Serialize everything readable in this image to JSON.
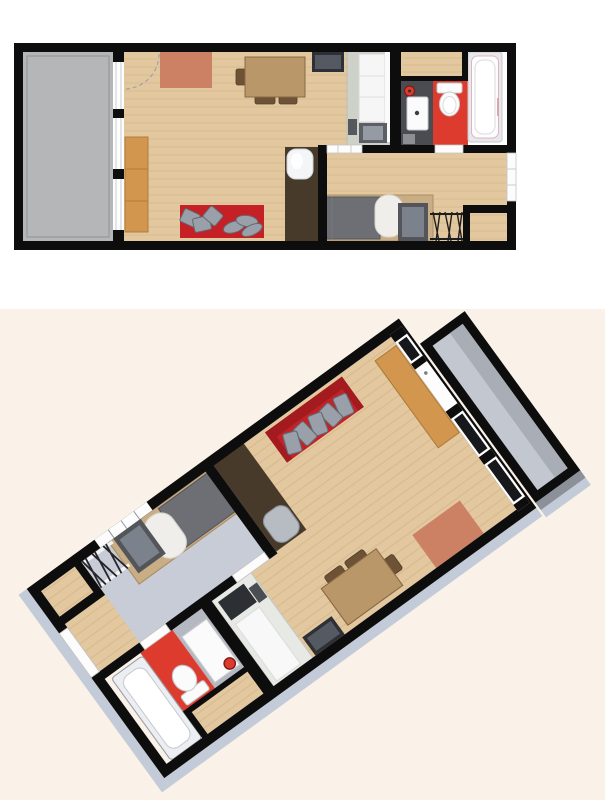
{
  "meta": {
    "title": "Studio apartment floor plan",
    "description": "Two renderings of the same studio apartment: a 2D top-down floor plan and a rotated 3D overview"
  },
  "views": [
    {
      "id": "plan-2d",
      "label": "2D top-down floor plan",
      "projection": "top-down",
      "background": "white"
    },
    {
      "id": "plan-3d",
      "label": "3D perspective floor plan",
      "projection": "rotated-overview",
      "rotation_deg": 144,
      "background": "cream"
    }
  ],
  "rooms": [
    {
      "id": "balcony",
      "name": "Balcony",
      "floor": "gray concrete"
    },
    {
      "id": "living-room",
      "name": "Living room",
      "floor": "light wood planks",
      "furniture": [
        "salmon rug",
        "dining table",
        "three brown chairs",
        "wall TV",
        "orange sideboard",
        "red sofa with six gray cushions",
        "dark wardrobe column with lamp"
      ]
    },
    {
      "id": "kitchenette",
      "name": "Kitchenette",
      "floor": "light wood planks",
      "furniture": [
        "counter unit",
        "tall white cabinet",
        "dark cooktop block"
      ]
    },
    {
      "id": "bathroom",
      "name": "Bathroom",
      "floor": "dark gray and red tile",
      "furniture": [
        "washbasin vanity",
        "round red stool",
        "toilet",
        "bathtub with pink trim"
      ]
    },
    {
      "id": "bedroom",
      "name": "Sleeping area",
      "floor": "light wood planks (gray in 3D view)",
      "furniture": [
        "single bed with gray duvet and white pillow",
        "dark desk",
        "laundry drying rack",
        "wall window"
      ]
    },
    {
      "id": "entry",
      "name": "Entry nook",
      "floor": "light wood planks",
      "furniture": [
        "entrance door"
      ]
    }
  ],
  "palette": {
    "bg-top": "#ffffff",
    "bg-bottom": "#faf2e8",
    "wall": "#0d0d0e",
    "balcony-floor": "#b5b6b8",
    "balcony-floor-3d": "#c3c7cf",
    "balcony-band-3d": "#a9adb5",
    "wood": "#e2c79f",
    "wood-line": "#d2b386",
    "gray-floor-3d": "#c8ccd6",
    "side-face": "#c2cbd7",
    "window-white": "#fdfdfd",
    "glass-dark": "#17181b",
    "rug-salmon": "#cc8165",
    "sofa-red": "#c52025",
    "sofa-red-dark": "#a31a1f",
    "cushion-gray": "#99a0aa",
    "table-brown": "#b99768",
    "chair-brown": "#6e5236",
    "cabinet-orange": "#d2964f",
    "wardrobe-brown": "#483a2a",
    "kitchen-counter": "#cdd1c7",
    "kitchen-counter-3d": "#e7e9e5",
    "appliance-dark": "#5c6066",
    "appliance-light": "#959ba3",
    "tv-dark": "#2d3035",
    "tv-screen": "#555a62",
    "bath-dark-floor": "#4a4c52",
    "bath-dark-floor-3d": "#b4b8c0",
    "bath-red": "#dc3b2e",
    "fixture-white": "#fbfbfc",
    "fixture-stroke": "#c7cad0",
    "tub-trim": "#e2b3b8",
    "bed-frame": "#c9ad85",
    "bed-duvet": "#6d6f74",
    "bed-pillow": "#efeeea",
    "desk-dark": "#53555b",
    "desk-top": "#7c828b",
    "lamp-3d": "#b7bbc2"
  }
}
